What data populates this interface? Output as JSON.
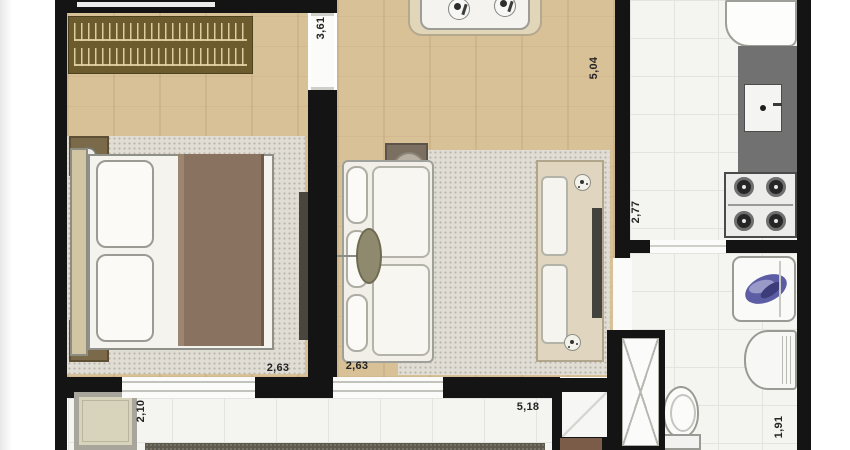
{
  "plan": {
    "type": "apartment-floor-plan",
    "dimension_labels": [
      {
        "id": "bedroom-depth",
        "value": "3,61",
        "orientation": "vertical"
      },
      {
        "id": "living-depth",
        "value": "5,04",
        "orientation": "vertical"
      },
      {
        "id": "kitchen-depth",
        "value": "2,77",
        "orientation": "vertical"
      },
      {
        "id": "bedroom-width",
        "value": "2,63",
        "orientation": "horizontal"
      },
      {
        "id": "living-width",
        "value": "2,63",
        "orientation": "horizontal"
      },
      {
        "id": "balcony-depth",
        "value": "2,10",
        "orientation": "vertical"
      },
      {
        "id": "balcony-width",
        "value": "5,18",
        "orientation": "horizontal"
      },
      {
        "id": "service-width",
        "value": "1,91",
        "orientation": "vertical"
      }
    ],
    "colors": {
      "wall": "#141414",
      "wood_floor": "#d9c197",
      "tile_floor": "#f4f4f1",
      "rug": "#e0ddd5",
      "wardrobe": "#6b5b2d",
      "counter": "#717171",
      "blanket": "#8a7260",
      "towel_blue": "#5d5da6"
    },
    "furniture": [
      "wardrobe",
      "double-bed",
      "pillows",
      "nightstands",
      "bedside-lamps",
      "bedroom-rug",
      "tv-panel-bedroom",
      "dining-table",
      "place-settings",
      "sofa",
      "floor-lamp",
      "side-table",
      "living-rug",
      "tv-sideboard",
      "plant-decor",
      "fridge",
      "kitchen-counter",
      "kitchen-sink",
      "gas-stove",
      "laundry-tank",
      "washing-machine",
      "toilet",
      "service-door",
      "shaft-window",
      "balcony-bench",
      "doormat",
      "hedge"
    ]
  }
}
